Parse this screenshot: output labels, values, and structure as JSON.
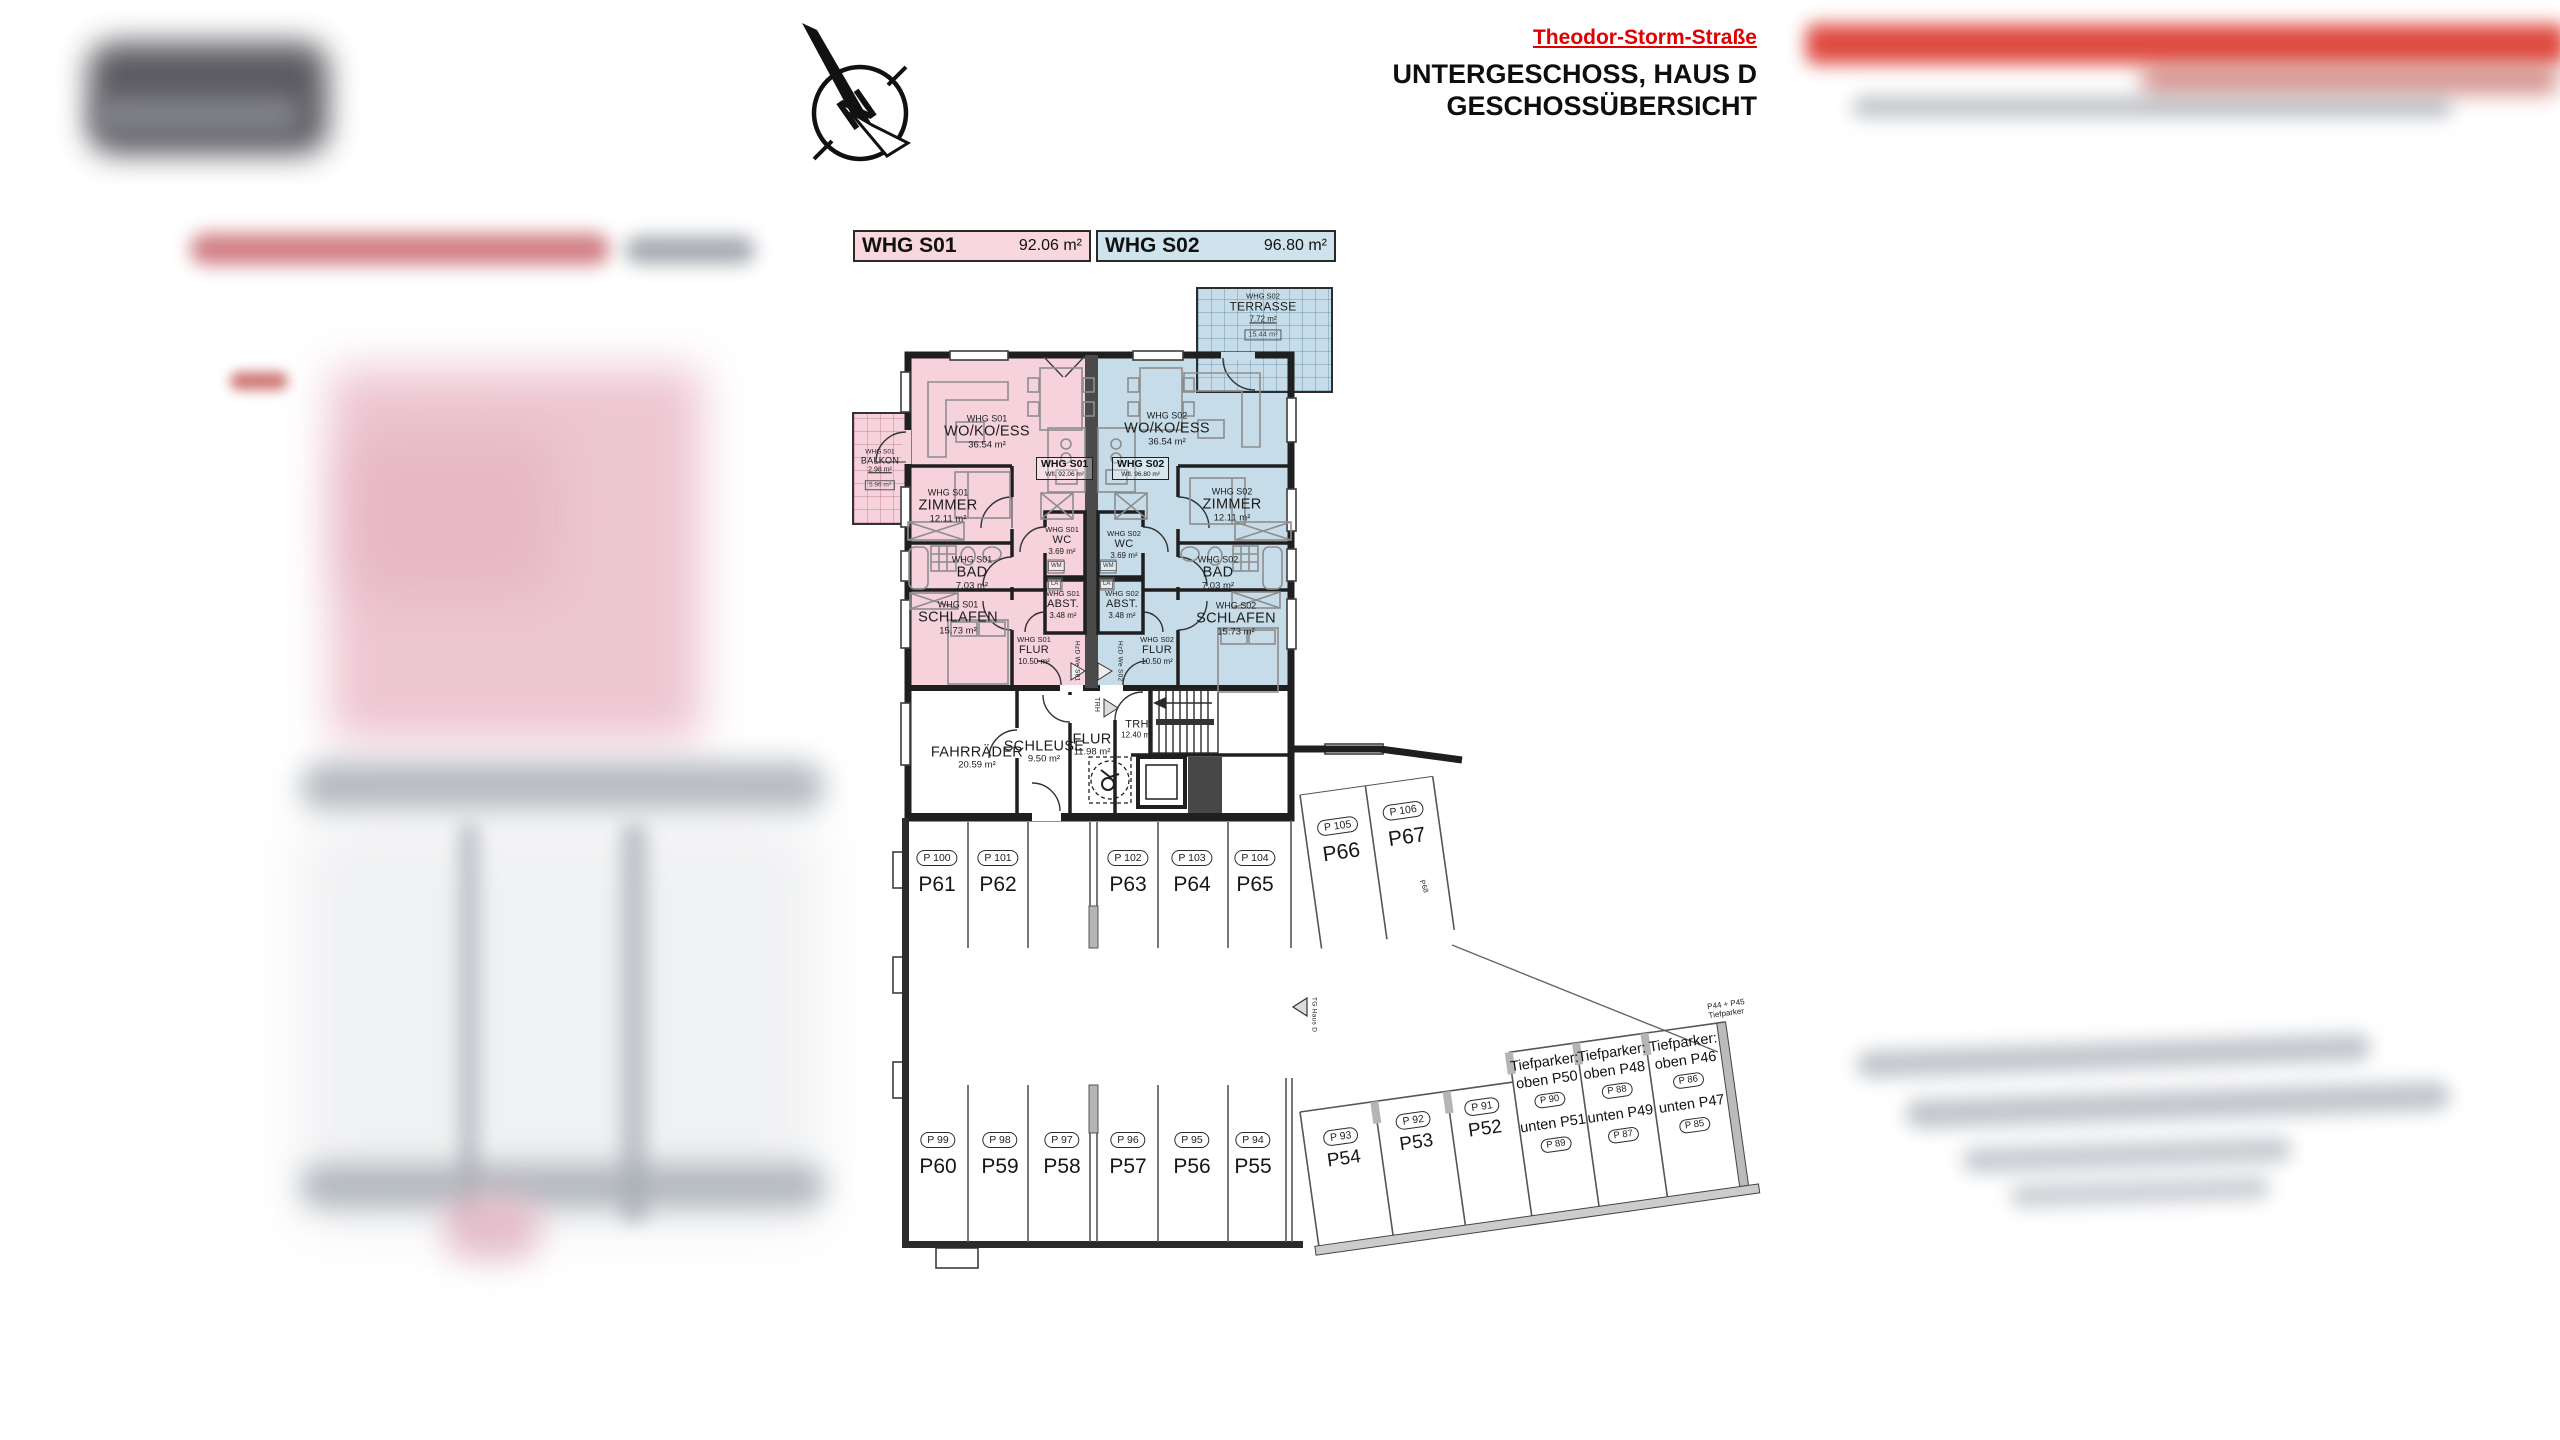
{
  "header": {
    "street": "Theodor-Storm-Straße",
    "title_line1": "UNTERGESCHOSS, HAUS D",
    "title_line2": "GESCHOSSÜBERSICHT"
  },
  "north_label": "N",
  "legend": {
    "s01_label": "WHG S01",
    "s01_area": "92.06 m²",
    "s02_label": "WHG S02",
    "s02_area": "96.80 m²"
  },
  "units": {
    "s01": {
      "tag": "WHG S01",
      "wfl": "Wfl. 92.06 m²",
      "wohnkoess": {
        "unit": "WHG S01",
        "name": "WO/KO/ESS",
        "area": "36.54 m²"
      },
      "zimmer": {
        "unit": "WHG S01",
        "name": "ZIMMER",
        "area": "12.11 m²"
      },
      "bad": {
        "unit": "WHG S01",
        "name": "BAD",
        "area": "7.03 m²"
      },
      "schlafen": {
        "unit": "WHG S01",
        "name": "SCHLAFEN",
        "area": "15.73 m²"
      },
      "wc": {
        "unit": "WHG S01",
        "name": "WC",
        "area": "3.69 m²"
      },
      "abst": {
        "unit": "WHG S01",
        "name": "ABST.",
        "area": "3.48 m²"
      },
      "flur": {
        "unit": "WHG S01",
        "name": "FLUR",
        "area": "10.50 m²"
      },
      "balkon": {
        "unit": "WHG S01",
        "name": "BALKON",
        "area": "2.98 m²",
        "area_half": "5.96 m²"
      }
    },
    "s02": {
      "tag": "WHG S02",
      "wfl": "Wfl. 96.80 m²",
      "wohnkoess": {
        "unit": "WHG S02",
        "name": "WO/KO/ESS",
        "area": "36.54 m²"
      },
      "zimmer": {
        "unit": "WHG S02",
        "name": "ZIMMER",
        "area": "12.11 m²"
      },
      "bad": {
        "unit": "WHG S02",
        "name": "BAD",
        "area": "7.03 m²"
      },
      "schlafen": {
        "unit": "WHG S02",
        "name": "SCHLAFEN",
        "area": "15.73 m²"
      },
      "wc": {
        "unit": "WHG S02",
        "name": "WC",
        "area": "3.69 m²"
      },
      "abst": {
        "unit": "WHG S02",
        "name": "ABST.",
        "area": "3.48 m²"
      },
      "flur": {
        "unit": "WHG S02",
        "name": "FLUR",
        "area": "10.50 m²"
      },
      "terrasse": {
        "unit": "WHG S02",
        "name": "TERRASSE",
        "area": "7.72 m²",
        "area_half": "15.44 m²"
      }
    }
  },
  "fixtures": {
    "wm": "WM",
    "la": "LA"
  },
  "common": {
    "fahrraeder": {
      "name": "FAHRRÄDER",
      "area": "20.59 m²"
    },
    "schleuse": {
      "name": "SCHLEUSE",
      "area": "9.50 m²"
    },
    "flur": {
      "name": "FLUR",
      "area": "11.98 m²"
    },
    "trh": {
      "name": "TRH",
      "area": "12.40 m²"
    }
  },
  "doors": {
    "entry_s01": "HzD We S01",
    "entry_s02": "HzD We S02",
    "trh_arrow": "TRH",
    "tg_arrow": "TG Haus D"
  },
  "parking": {
    "top_row": [
      {
        "stall": "P61",
        "badge": "P 100"
      },
      {
        "stall": "P62",
        "badge": "P 101"
      },
      {
        "stall": "P63",
        "badge": "P 102"
      },
      {
        "stall": "P64",
        "badge": "P 103"
      },
      {
        "stall": "P65",
        "badge": "P 104"
      }
    ],
    "diag_row": [
      {
        "stall": "P66",
        "badge": "P 105"
      },
      {
        "stall": "P67",
        "badge": "P 106"
      }
    ],
    "bottom_row": [
      {
        "stall": "P60",
        "badge": "P 99"
      },
      {
        "stall": "P59",
        "badge": "P 98"
      },
      {
        "stall": "P58",
        "badge": "P 97"
      },
      {
        "stall": "P57",
        "badge": "P 96"
      },
      {
        "stall": "P56",
        "badge": "P 95"
      },
      {
        "stall": "P55",
        "badge": "P 94"
      }
    ],
    "wing_row": [
      {
        "stall": "P54",
        "badge": "P 93"
      },
      {
        "stall": "P53",
        "badge": "P 92"
      },
      {
        "stall": "P52",
        "badge": "P 91"
      }
    ],
    "tiefparker": [
      {
        "title": "Tiefparker:",
        "oben": "oben P50",
        "oben_badge": "P 90",
        "unten": "unten P51",
        "unten_badge": "P 89"
      },
      {
        "title": "Tiefparker:",
        "oben": "oben P48",
        "oben_badge": "P 88",
        "unten": "unten P49",
        "unten_badge": "P 87"
      },
      {
        "title": "Tiefparker:",
        "oben": "oben P46",
        "oben_badge": "P 86",
        "unten": "unten P47",
        "unten_badge": "P 85"
      }
    ],
    "p68": "P68",
    "p44_45_line1": "P44 + P45",
    "p44_45_line2": "Tiefparker"
  },
  "colors": {
    "s01_fill": "#f5d2dc",
    "s02_fill": "#c6dde9",
    "accent_red": "#e00000",
    "wall": "#1f1f1f"
  }
}
